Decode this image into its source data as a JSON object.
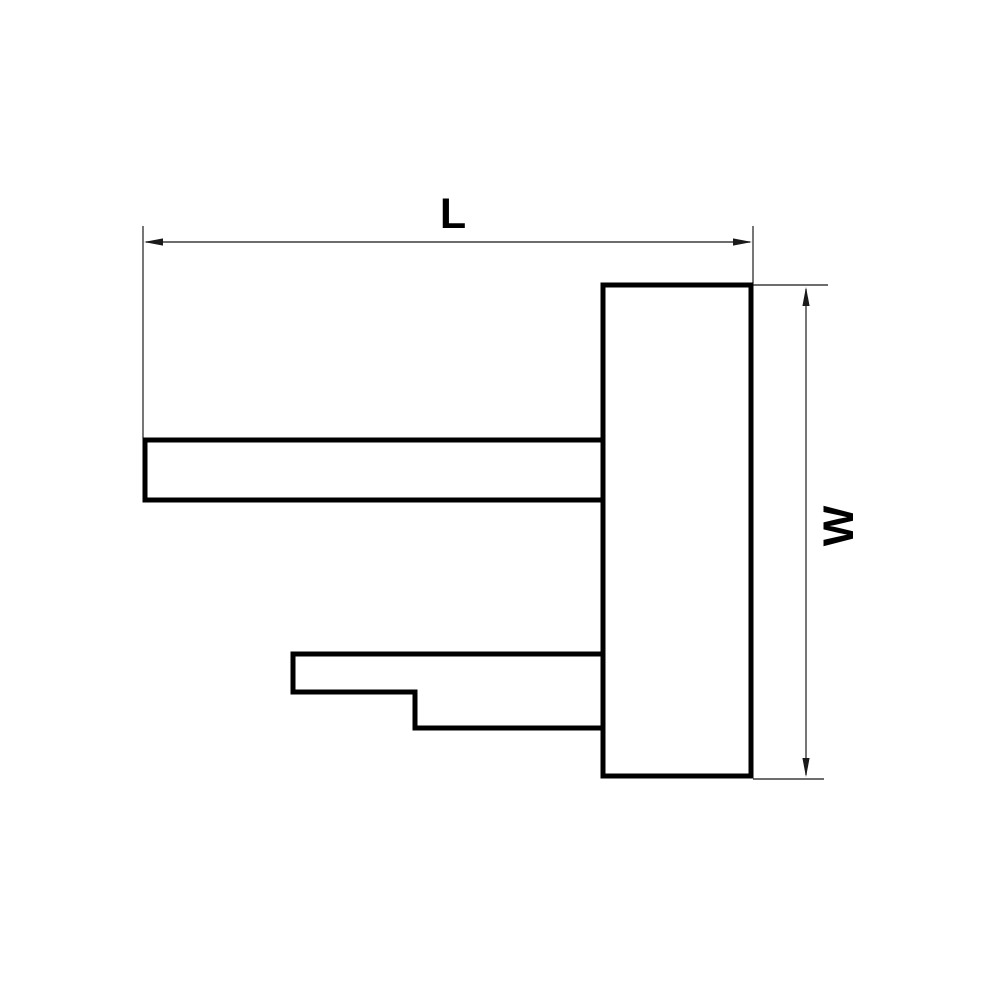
{
  "drawing": {
    "kind": "dimensioned-part-side-view",
    "labels": {
      "length": "L",
      "width": "W"
    },
    "colors": {
      "background": "#ffffff",
      "object_line": "#000000",
      "dimension_line": "#3d3d3d",
      "text": "#000000"
    }
  }
}
